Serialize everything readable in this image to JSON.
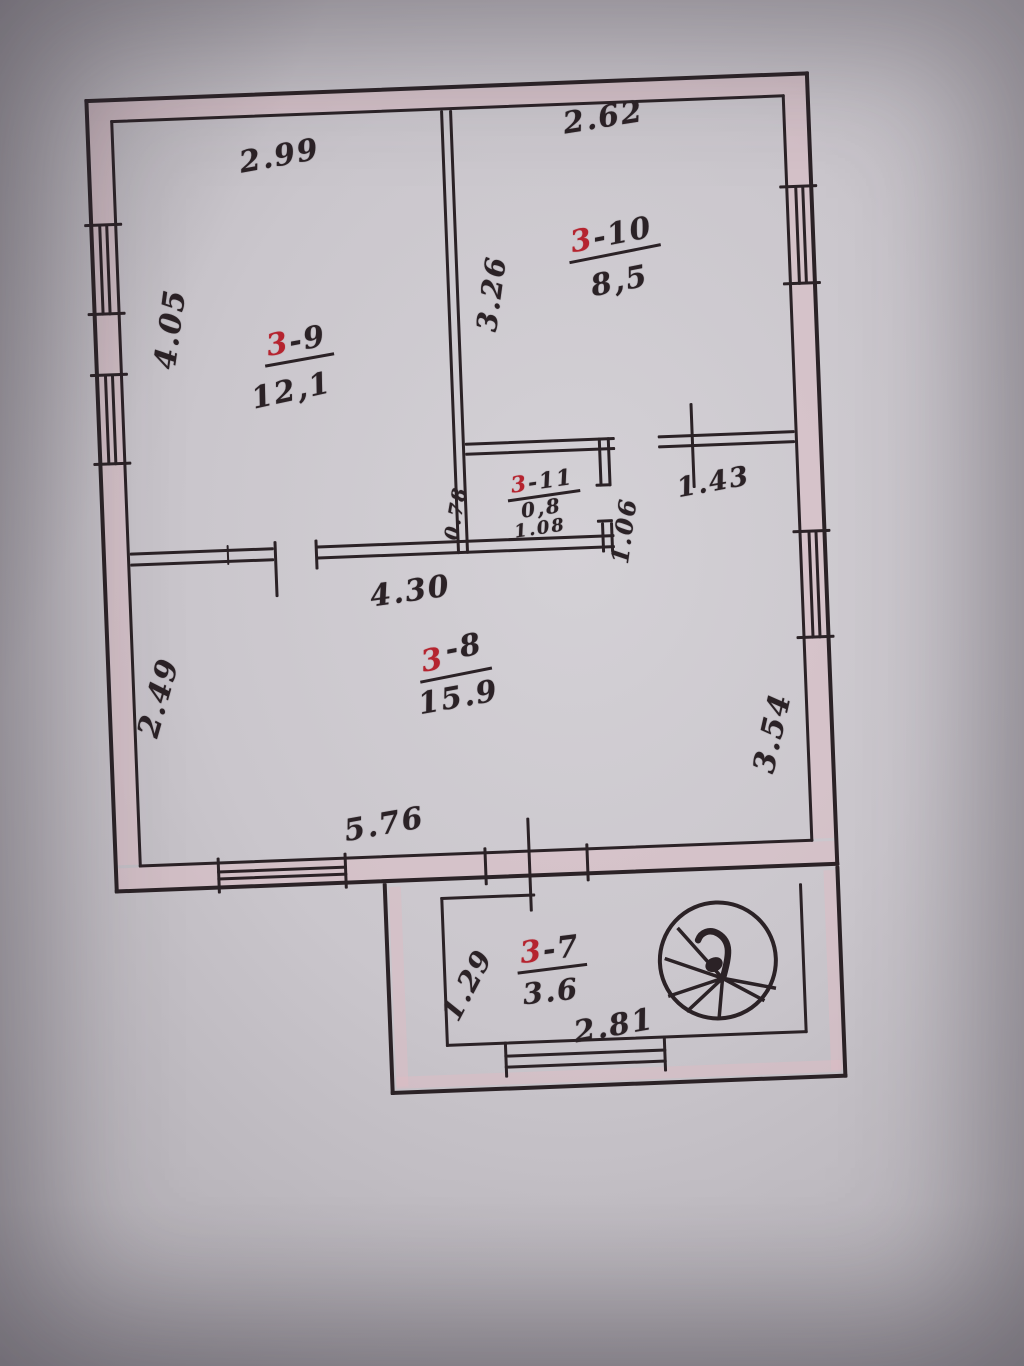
{
  "photo": {
    "paper_color": "#c9c5cb",
    "ink_color": "#2b2226",
    "red_ink_color": "#b5242f",
    "wall_tint_color": "#debcc4"
  },
  "rooms": {
    "r39": {
      "prefix": "3",
      "suffix": "-9",
      "area": "12,1"
    },
    "r310": {
      "prefix": "3",
      "suffix": "-10",
      "area": "8,5"
    },
    "r311": {
      "prefix": "3",
      "suffix": "-11",
      "area": "0,8",
      "extra": "1.08"
    },
    "r38": {
      "prefix": "3",
      "suffix": "-8",
      "area": "15.9"
    },
    "r37": {
      "prefix": "3",
      "suffix": "-7",
      "area": "3.6"
    }
  },
  "dims": {
    "d299": "2.99",
    "d262": "2.62",
    "d405": "4.05",
    "d326": "3.26",
    "d143": "1.43",
    "d078": "0.78",
    "d106": "1.06",
    "d430": "4.30",
    "d249": "2.49",
    "d576": "5.76",
    "d354": "3.54",
    "d129": "1.29",
    "d281": "2.81"
  },
  "icons": {
    "staircase": "spiral-staircase"
  }
}
